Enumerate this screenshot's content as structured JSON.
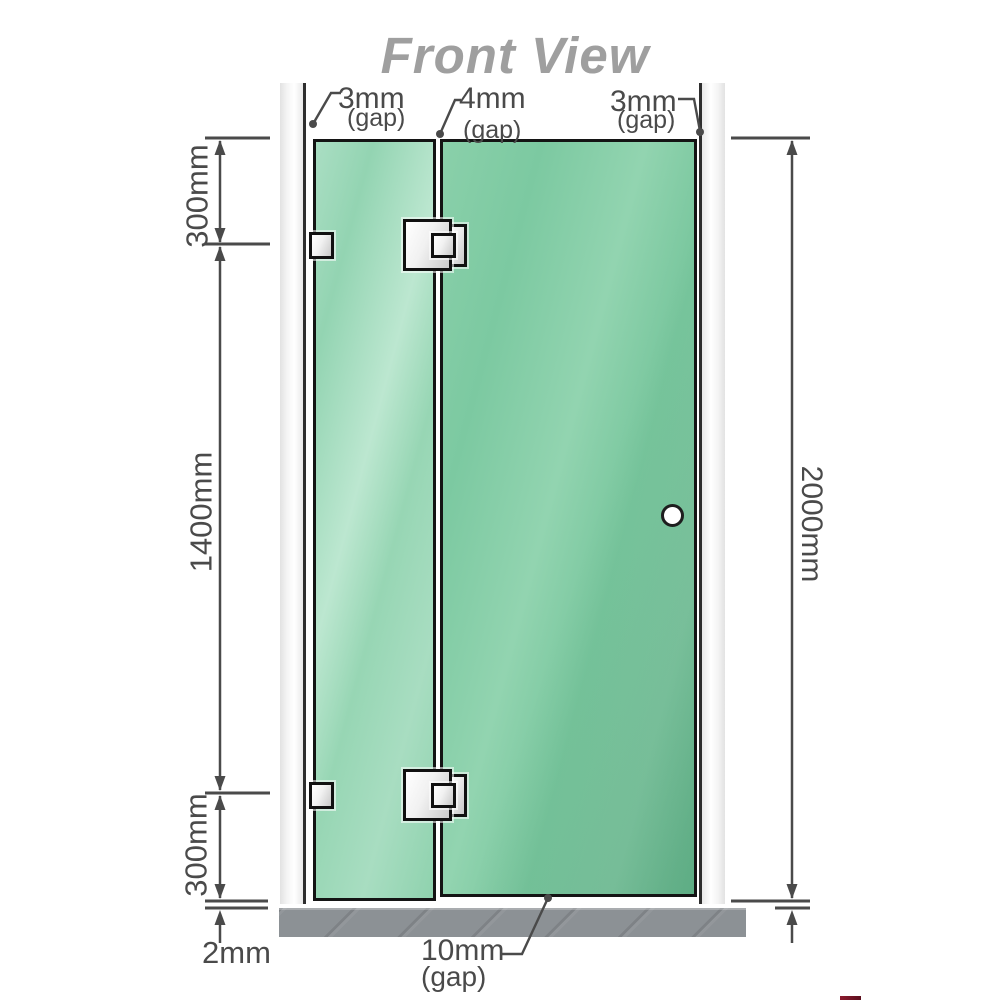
{
  "title": "Front View",
  "view": {
    "top_gap_labels": [
      {
        "value": "3mm",
        "note": "(gap)"
      },
      {
        "value": "4mm",
        "note": "(gap)"
      },
      {
        "value": "3mm",
        "note": "(gap)"
      }
    ],
    "left_dimensions": {
      "top": "300mm",
      "middle": "1400mm",
      "bottom": "300mm"
    },
    "right_dimension": "2000mm",
    "floor_gap_label": "2mm",
    "bottom_gap_label": {
      "value": "10mm",
      "note": "(gap)"
    }
  },
  "colors": {
    "door_glass": "#7cc9a1",
    "fixed_glass": "#9dd8b9",
    "wall": "#ebebeb",
    "floor": "#8c9195",
    "dimension_lines": "#4a4a4a",
    "title_text": "#9f9f9f",
    "hardware": "#e8e8e8"
  }
}
